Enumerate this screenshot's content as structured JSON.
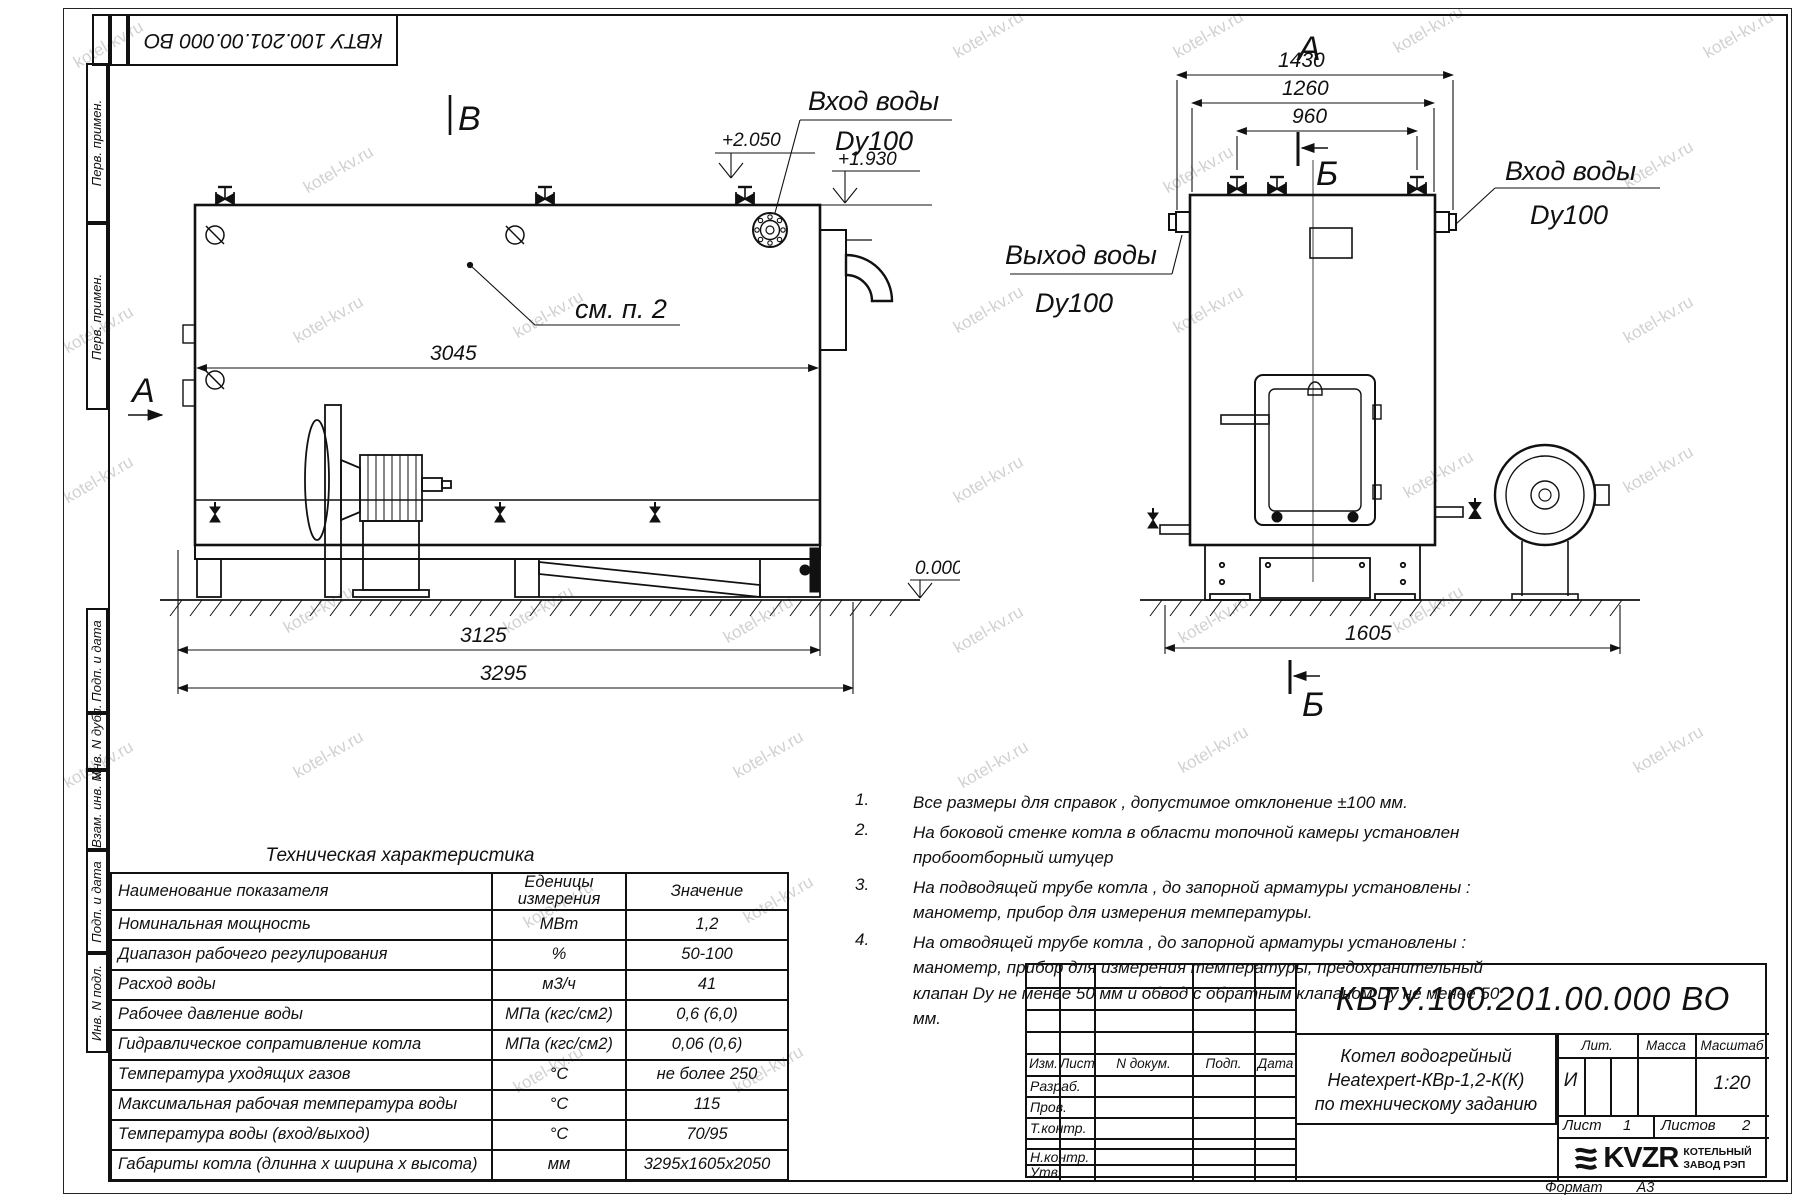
{
  "watermark": {
    "text": "kotel-kv.ru"
  },
  "stamp": {
    "code": "КВТУ 100.201.00.000 ВО"
  },
  "margin_labels": [
    "Перв. примен.",
    "Перв. примен.",
    "Подп. и дата",
    "Инв. N дубл.",
    "Взам. инв. N",
    "Подп. и дата",
    "Инв. N подл."
  ],
  "side_view": {
    "view_label": "В",
    "direction_label": "А",
    "inlet_label": "Вход воды",
    "inlet_dn": "Dy100",
    "callout": "см. п. 2",
    "dims": {
      "length_inner": "3045",
      "length_frame": "3125",
      "length_total": "3295"
    },
    "elevations": {
      "top": "+2.050",
      "mid": "+1.930",
      "zero": "0.000"
    }
  },
  "front_view": {
    "view_label": "А",
    "section_top": "Б",
    "section_bottom": "Б",
    "outlet_label": "Выход воды",
    "outlet_dn": "Dy100",
    "inlet_label": "Вход воды",
    "inlet_dn": "Dy100",
    "dims": {
      "width_outer": "1430",
      "width_body": "1260",
      "width_valves": "960",
      "width_total": "1605"
    }
  },
  "spec_table": {
    "title": "Техническая характеристика",
    "col_name": "Наименование показателя",
    "col_units": "Еденицы\nизмерения",
    "col_value": "Значение",
    "rows": [
      {
        "name": "Номинальная мощность",
        "unit": "МВт",
        "value": "1,2"
      },
      {
        "name": "Диапазон рабочего регулирования",
        "unit": "%",
        "value": "50-100"
      },
      {
        "name": "Расход воды",
        "unit": "м3/ч",
        "value": "41"
      },
      {
        "name": "Рабочее давление воды",
        "unit": "МПа (кгс/см2)",
        "value": "0,6 (6,0)"
      },
      {
        "name": "Гидравлическое сопративление котла",
        "unit": "МПа (кгс/см2)",
        "value": "0,06 (0,6)"
      },
      {
        "name": "Температура уходящих газов",
        "unit": "°С",
        "value": "не более 250"
      },
      {
        "name": "Максимальная рабочая температура воды",
        "unit": "°С",
        "value": "115"
      },
      {
        "name": "Температура воды (вход/выход)",
        "unit": "°С",
        "value": "70/95"
      },
      {
        "name": "Габариты котла (длинна х ширина х высота)",
        "unit": "мм",
        "value": "3295х1605х2050"
      }
    ]
  },
  "notes": {
    "items": [
      {
        "num": "1.",
        "text": "Все размеры для справок , допустимое отклонение  ±100 мм."
      },
      {
        "num": "2.",
        "text": "На боковой стенке котла в области топочной камеры установлен пробоотборный штуцер"
      },
      {
        "num": "3.",
        "text": "На  подводящей трубе котла , до запорной арматуры установлены : манометр, прибор для измерения температуры."
      },
      {
        "num": "4.",
        "text": "На отводящей трубе котла , до запорной арматуры установлены : манометр, прибор для измерения температуры, предохранительный клапан  Dу не менее  50 мм и обвод с обратным клапаном  Dу не менее  50 мм."
      }
    ]
  },
  "title_block": {
    "doc_number": "КВТУ.100.201.00.000 ВО",
    "header_cells": [
      "Изм.",
      "Лист",
      "N докум.",
      "Подп.",
      "Дата"
    ],
    "row_labels": [
      "Разраб.",
      "Пров.",
      "Т.контр.",
      "Н.контр.",
      "Утв."
    ],
    "name_line1": "Котел водогрейный",
    "name_line2": "Heatexpert-КВр-1,2-К(К)",
    "name_line3": "по техническому заданию",
    "lit_label": "Лит.",
    "mass_label": "Масса",
    "scale_label": "Масштаб",
    "lit_value": "И",
    "scale_value": "1:20",
    "sheet_label": "Лист",
    "sheet_value": "1",
    "sheets_label": "Листов",
    "sheets_value": "2",
    "logo_text": "KVZR",
    "org_line1": "КОТЕЛЬНЫЙ",
    "org_line2": "ЗАВОД РЭП",
    "format_label": "Формат",
    "format_value": "А3"
  }
}
